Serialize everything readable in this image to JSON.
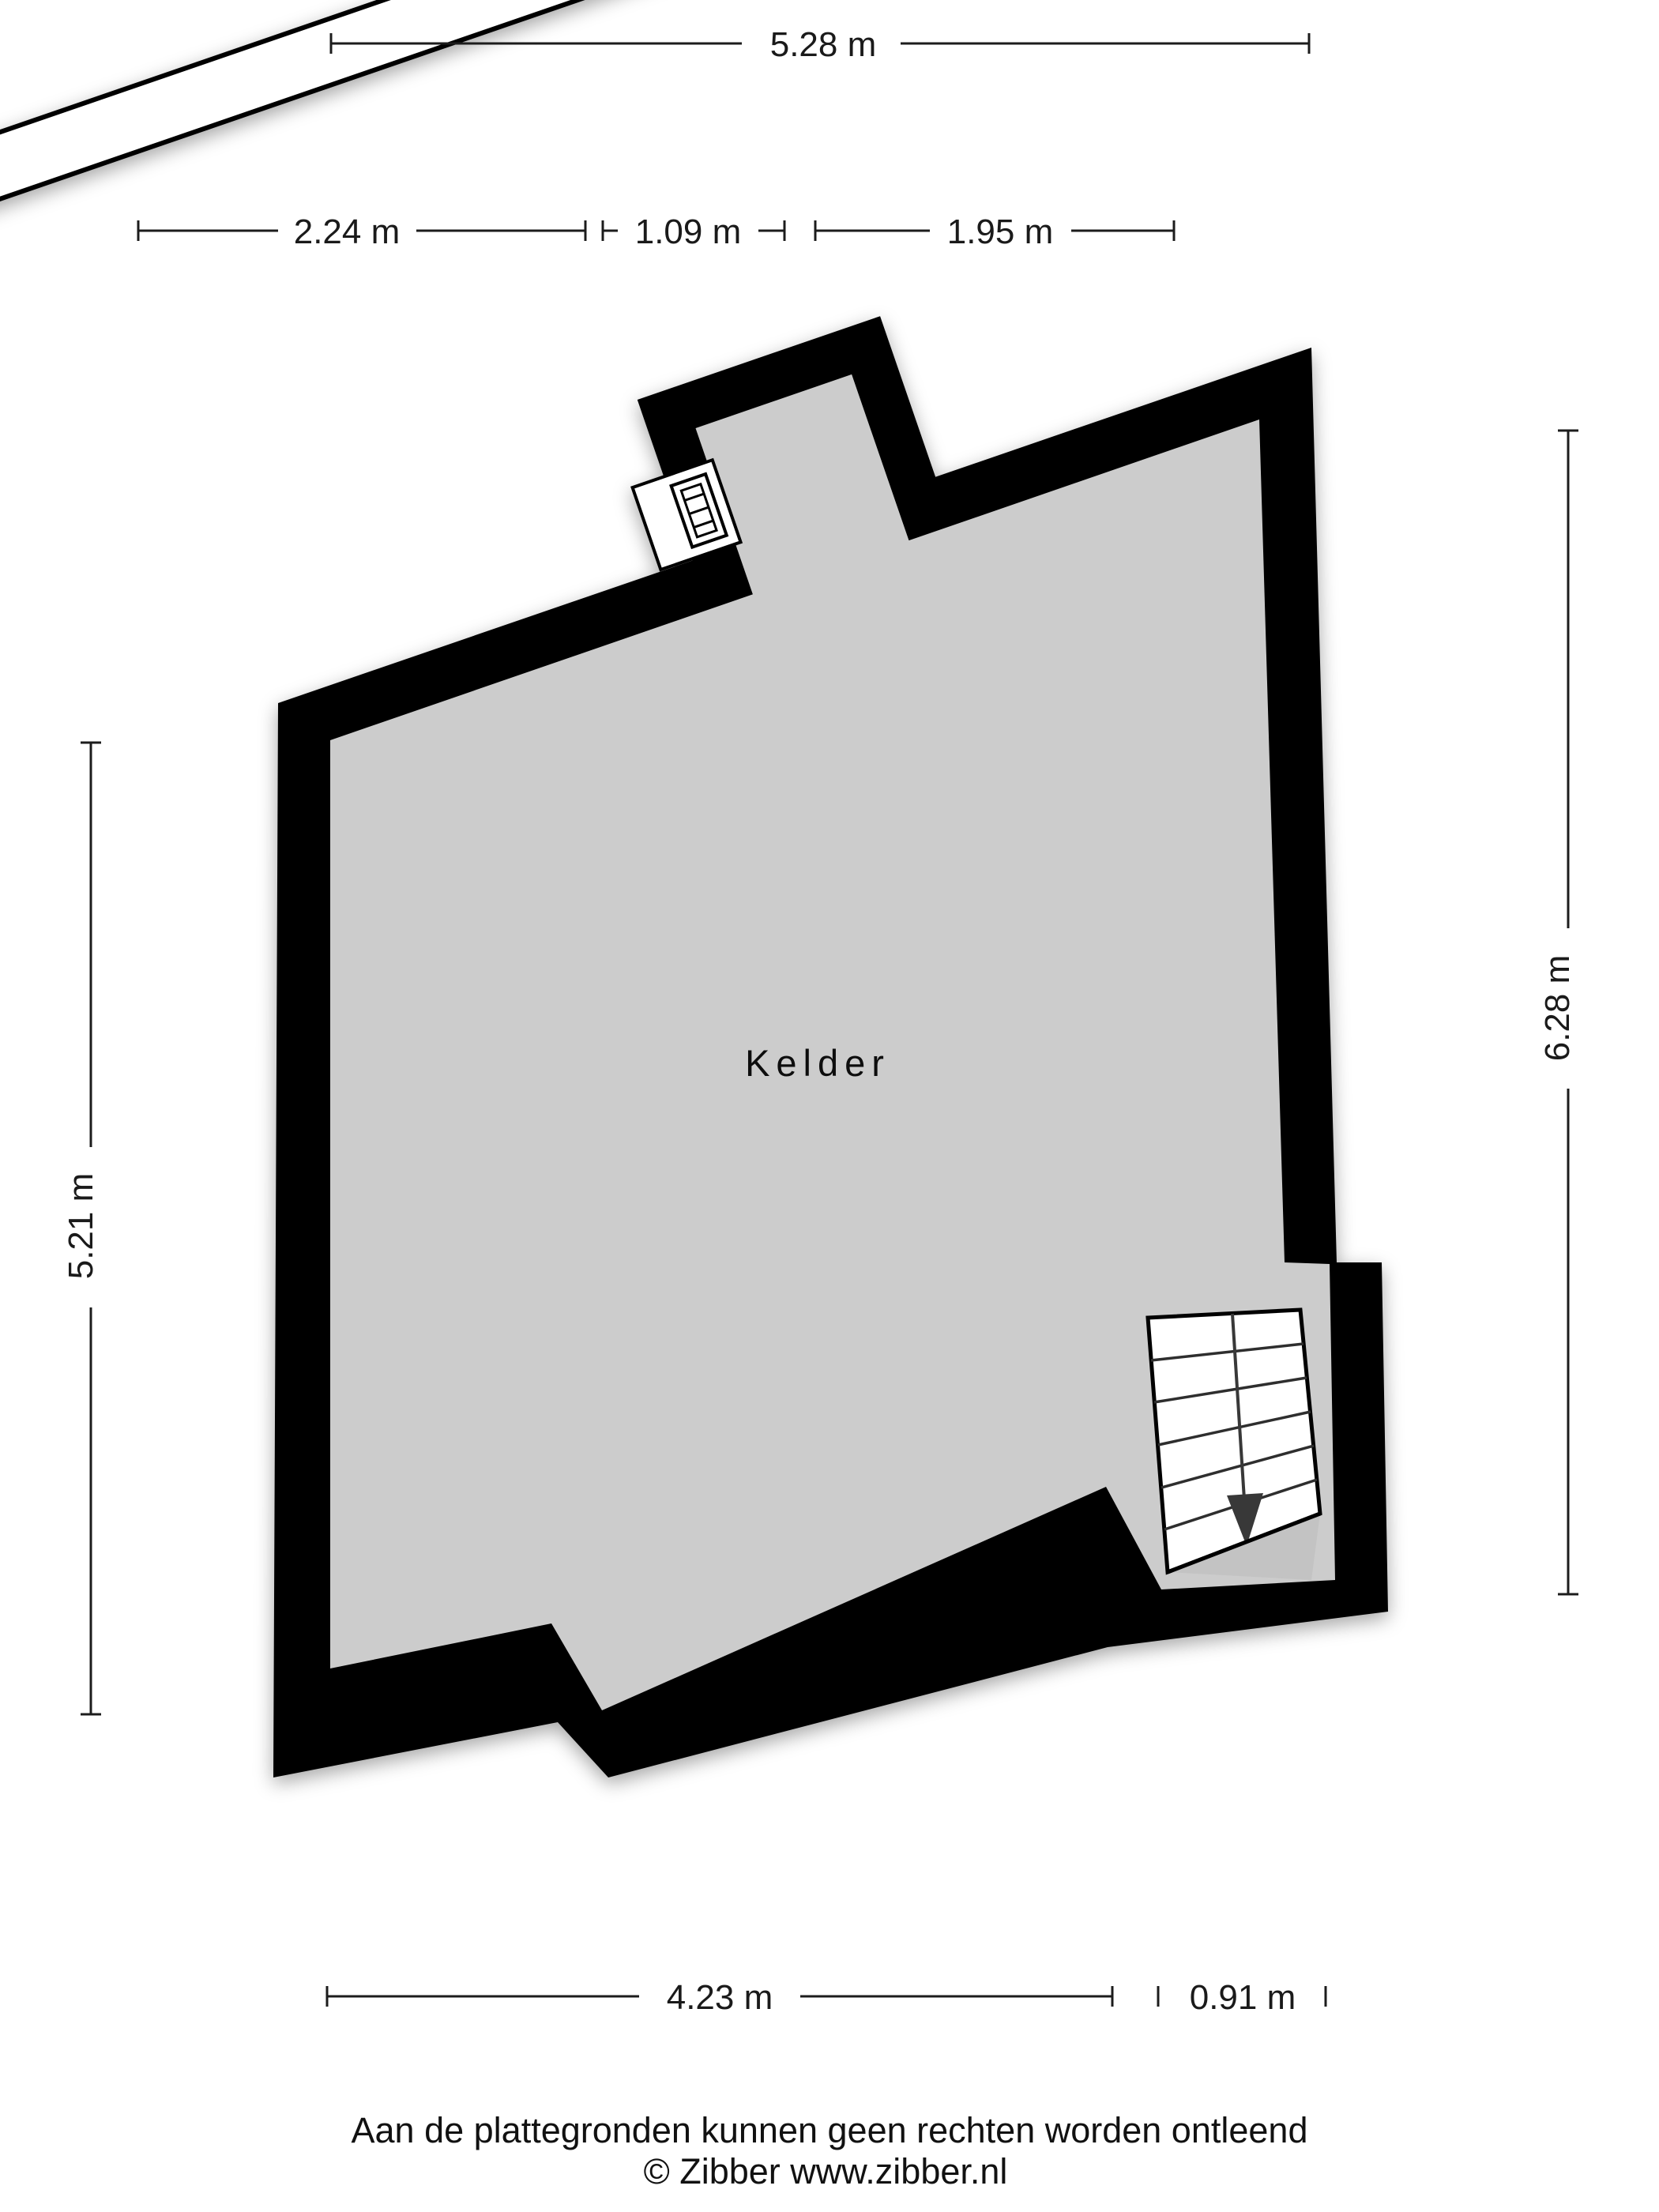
{
  "floorplan": {
    "room_label": "Kelder"
  },
  "dimensions": {
    "top_total": "5.28 m",
    "top_left": "2.24 m",
    "top_middle": "1.09 m",
    "top_right": "1.95 m",
    "left_side": "5.21 m",
    "right_side": "6.28 m",
    "bottom_left": "4.23 m",
    "bottom_right": "0.91 m"
  },
  "footer": {
    "disclaimer": "Aan de plattegronden kunnen geen rechten worden ontleend",
    "copyright": "© Zibber www.zibber.nl"
  },
  "colors": {
    "wall": "#000000",
    "floor": "#cccccc",
    "fold_triangle": "#c3c3c3",
    "beam": "#ffffff",
    "stair": "#ffffff",
    "dim_line": "#1c1c1c",
    "arrow": "#383838"
  }
}
